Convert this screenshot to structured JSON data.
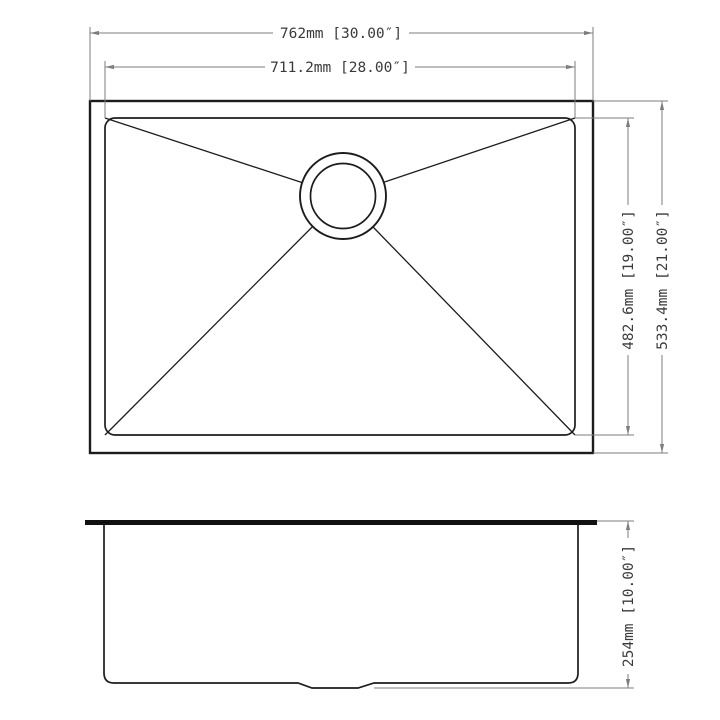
{
  "drawing": {
    "top_view": {
      "outer_width_label": "762mm [30.00″]",
      "inner_width_label": "711.2mm [28.00″]",
      "inner_depth_label": "482.6mm [19.00″]",
      "outer_depth_label": "533.4mm [21.00″]"
    },
    "side_view": {
      "height_label": "254mm [10.00″]"
    },
    "colors": {
      "drawing_line": "#1c1c1c",
      "dimension_line": "#7e7e7e",
      "text": "#3a3a3a",
      "background": "#ffffff"
    }
  }
}
